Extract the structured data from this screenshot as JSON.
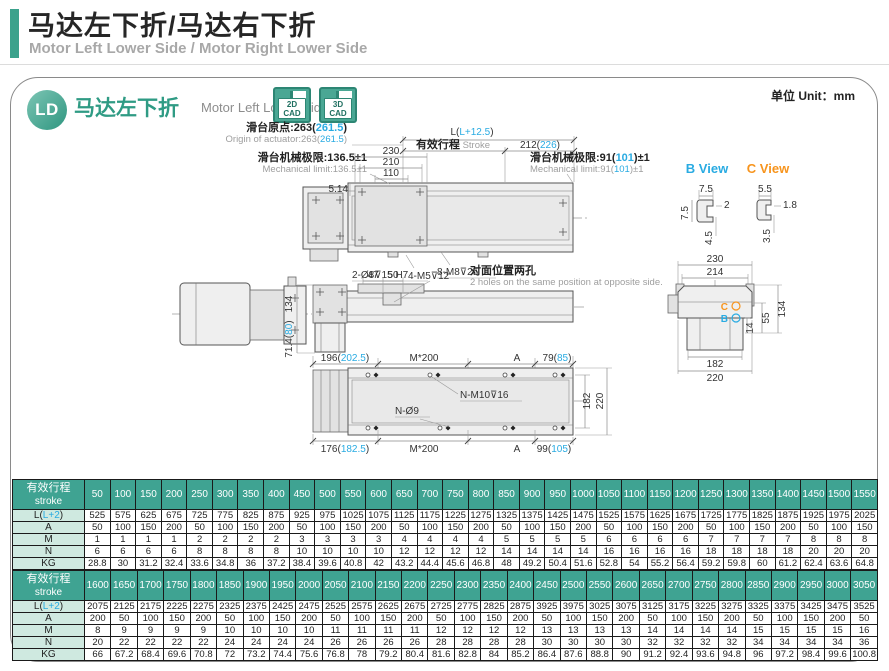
{
  "page": {
    "title_cn": "马达左下折/马达右下折",
    "title_en": "Motor Left Lower Side / Motor Right Lower Side",
    "unit_label": "单位 Unit：mm"
  },
  "panel_header": {
    "badge": "LD",
    "model_cn": "马达左下折",
    "model_en": "Motor Left Lower Side",
    "cad2d_line1": "2D",
    "cad2d_line2": "CAD",
    "cad3d_line1": "3D",
    "cad3d_line2": "CAD"
  },
  "colors": {
    "teal": "#3fa392",
    "teal_dark": "#2d8674",
    "cyan": "#29abe2",
    "orange": "#f7941d",
    "label_cell_bg": "#cfe9e0",
    "gray_text": "#9e9e9e"
  },
  "drawing": {
    "dim_L": [
      "L(",
      "L+12.5",
      ")"
    ],
    "stroke_cn": "有效行程",
    "stroke_en": " Stroke",
    "dim_212": [
      "212(",
      "226",
      ")"
    ],
    "origin_cn": [
      "滑台原点:263(",
      "261.5",
      ")"
    ],
    "origin_en": [
      "Origin of actuator:263(",
      "261.5",
      ")"
    ],
    "mech_left_cn": "滑台机械极限:136.5±1",
    "mech_left_en": "Mechanical limit:136.5±1",
    "mech_right_cn": [
      "滑台机械极限:91(",
      "101",
      ")±1"
    ],
    "mech_right_en": [
      "Mechanical limit:91(",
      "101",
      ")±1"
    ],
    "dim_230": "230",
    "dim_210": "210",
    "dim_110": "110",
    "dim_514": "5.14",
    "holes_top1": "2-Ø8⊽15 H7",
    "holes_top2": "8-M8⊽25",
    "dim_47": "47",
    "dim_50": "50",
    "holes_mid": "4-M5⊽12",
    "note_cn": "对面位置两孔",
    "note_en": "2 holes on the same position at opposite side.",
    "dim_134_side": "134",
    "dim_714": [
      "71.4(",
      "80",
      ")"
    ],
    "dim_196": [
      "196(",
      "202.5",
      ")"
    ],
    "dim_m200_top": "M*200",
    "dim_A_top": "A",
    "dim_79": [
      "79(",
      "85",
      ")"
    ],
    "holes_nm10": "N-M10⊽16",
    "holes_n9": "N-Ø9",
    "dim_182_v": "182",
    "dim_220_v": "220",
    "dim_176": [
      "176(",
      "182.5",
      ")"
    ],
    "dim_m200_bot": "M*200",
    "dim_A_bot": "A",
    "dim_99": [
      "99(",
      "105",
      ")"
    ],
    "b_view": "B View",
    "c_view": "C View",
    "b_75_top": "7.5",
    "b_2": "2",
    "b_75_left": "7.5",
    "b_45": "4.5",
    "c_55": "5.5",
    "c_18": "1.8",
    "c_35": "3.5",
    "e_230": "230",
    "e_214": "214",
    "e_134": "134",
    "e_55": "55",
    "e_14": "14",
    "e_182": "182",
    "e_220": "220",
    "marker_c": "C",
    "marker_b": "B"
  },
  "tables": [
    {
      "header_cn": "有效行程",
      "header_en": "stroke",
      "strokes": [
        50,
        100,
        150,
        200,
        250,
        300,
        350,
        400,
        450,
        500,
        550,
        600,
        650,
        700,
        750,
        800,
        850,
        900,
        950,
        1000,
        1050,
        1100,
        1150,
        1200,
        1250,
        1300,
        1350,
        1400,
        1450,
        1500,
        1550
      ],
      "rows": [
        {
          "label": [
            "L(",
            "L+2",
            ")"
          ],
          "values": [
            525,
            575,
            625,
            675,
            725,
            775,
            825,
            875,
            925,
            975,
            1025,
            1075,
            1125,
            1175,
            1225,
            1275,
            1325,
            1375,
            1425,
            1475,
            1525,
            1575,
            1625,
            1675,
            1725,
            1775,
            1825,
            1875,
            1925,
            1975,
            2025
          ]
        },
        {
          "label": [
            "A"
          ],
          "values": [
            50,
            100,
            150,
            200,
            50,
            100,
            150,
            200,
            50,
            100,
            150,
            200,
            50,
            100,
            150,
            200,
            50,
            100,
            150,
            200,
            50,
            100,
            150,
            200,
            50,
            100,
            150,
            200,
            50,
            100,
            150
          ]
        },
        {
          "label": [
            "M"
          ],
          "values": [
            1,
            1,
            1,
            1,
            2,
            2,
            2,
            2,
            3,
            3,
            3,
            3,
            4,
            4,
            4,
            4,
            5,
            5,
            5,
            5,
            6,
            6,
            6,
            6,
            7,
            7,
            7,
            7,
            8,
            8,
            8
          ]
        },
        {
          "label": [
            "N"
          ],
          "values": [
            6,
            6,
            6,
            6,
            8,
            8,
            8,
            8,
            10,
            10,
            10,
            10,
            12,
            12,
            12,
            12,
            14,
            14,
            14,
            14,
            16,
            16,
            16,
            16,
            18,
            18,
            18,
            18,
            20,
            20,
            20
          ]
        },
        {
          "label": [
            "KG"
          ],
          "values": [
            28.8,
            30,
            31.2,
            32.4,
            33.6,
            34.8,
            36,
            37.2,
            38.4,
            39.6,
            40.8,
            42,
            43.2,
            44.4,
            45.6,
            46.8,
            48,
            49.2,
            50.4,
            51.6,
            52.8,
            54,
            55.2,
            56.4,
            59.2,
            59.8,
            60,
            61.2,
            62.4,
            63.6,
            64.8
          ]
        }
      ]
    },
    {
      "header_cn": "有效行程",
      "header_en": "stroke",
      "strokes": [
        1600,
        1650,
        1700,
        1750,
        1800,
        1850,
        1900,
        1950,
        2000,
        2050,
        2100,
        2150,
        2200,
        2250,
        2300,
        2350,
        2400,
        2450,
        2500,
        2550,
        2600,
        2650,
        2700,
        2750,
        2800,
        2850,
        2900,
        2950,
        3000,
        3050
      ],
      "rows": [
        {
          "label": [
            "L(",
            "L+2",
            ")"
          ],
          "values": [
            2075,
            2125,
            2175,
            2225,
            2275,
            2325,
            2375,
            2425,
            2475,
            2525,
            2575,
            2625,
            2675,
            2725,
            2775,
            2825,
            2875,
            3925,
            3975,
            3025,
            3075,
            3125,
            3175,
            3225,
            3275,
            3325,
            3375,
            3425,
            3475,
            3525
          ]
        },
        {
          "label": [
            "A"
          ],
          "values": [
            200,
            50,
            100,
            150,
            200,
            50,
            100,
            150,
            200,
            50,
            100,
            150,
            200,
            50,
            100,
            150,
            200,
            50,
            100,
            150,
            200,
            50,
            100,
            150,
            200,
            50,
            100,
            150,
            200,
            50
          ]
        },
        {
          "label": [
            "M"
          ],
          "values": [
            8,
            9,
            9,
            9,
            9,
            10,
            10,
            10,
            10,
            11,
            11,
            11,
            11,
            12,
            12,
            12,
            12,
            13,
            13,
            13,
            13,
            14,
            14,
            14,
            14,
            15,
            15,
            15,
            15,
            16
          ]
        },
        {
          "label": [
            "N"
          ],
          "values": [
            20,
            22,
            22,
            22,
            22,
            24,
            24,
            24,
            24,
            26,
            26,
            26,
            26,
            28,
            28,
            28,
            28,
            30,
            30,
            30,
            30,
            32,
            32,
            32,
            32,
            34,
            34,
            34,
            34,
            36
          ]
        },
        {
          "label": [
            "KG"
          ],
          "values": [
            66,
            67.2,
            68.4,
            69.6,
            70.8,
            72,
            73.2,
            74.4,
            75.6,
            76.8,
            78,
            79.2,
            80.4,
            81.6,
            82.8,
            84,
            85.2,
            86.4,
            87.6,
            88.8,
            90,
            91.2,
            92.4,
            93.6,
            94.8,
            96,
            97.2,
            98.4,
            99.6,
            100.8
          ]
        }
      ]
    }
  ]
}
